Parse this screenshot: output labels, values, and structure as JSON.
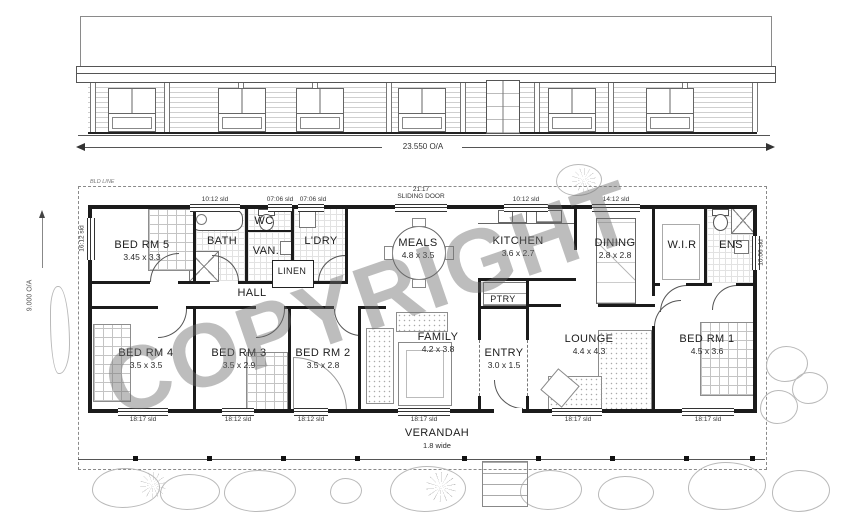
{
  "watermark": "COPYRIGHT",
  "elevation": {
    "overall_width": "23.550 O/A"
  },
  "plan": {
    "building_line_label": "BLD LINE",
    "overall_depth": "9.000 O/A",
    "verandah": {
      "name": "VERANDAH",
      "size": "1.8 wide"
    },
    "rooms": [
      {
        "name": "BED RM 5",
        "size": "3.45 x 3.3"
      },
      {
        "name": "BATH",
        "size": ""
      },
      {
        "name": "WC",
        "size": ""
      },
      {
        "name": "VAN.",
        "size": ""
      },
      {
        "name": "L'DRY",
        "size": ""
      },
      {
        "name": "LINEN",
        "size": ""
      },
      {
        "name": "HALL",
        "size": ""
      },
      {
        "name": "MEALS",
        "size": "4.8 x 3.5"
      },
      {
        "name": "KITCHEN",
        "size": "3.6 x 2.7"
      },
      {
        "name": "PTRY",
        "size": ""
      },
      {
        "name": "DINING",
        "size": "2.8 x 2.8"
      },
      {
        "name": "W.I.R",
        "size": ""
      },
      {
        "name": "ENS",
        "size": ""
      },
      {
        "name": "BED RM 4",
        "size": "3.5 x 3.5"
      },
      {
        "name": "BED RM 3",
        "size": "3.5 x 2.9"
      },
      {
        "name": "BED RM 2",
        "size": "3.5 x 2.8"
      },
      {
        "name": "FAMILY",
        "size": "4.2 x 3.8"
      },
      {
        "name": "ENTRY",
        "size": "3.0 x 1.5"
      },
      {
        "name": "LOUNGE",
        "size": "4.4 x 4.3"
      },
      {
        "name": "BED RM 1",
        "size": "4.5 x 3.6"
      }
    ],
    "openings": {
      "sliding_door_code": "21:17",
      "sliding_door_label": "SLIDING DOOR",
      "top": [
        "10:12 sld",
        "07:06 sld",
        "07:06 sld",
        "10:12 sld",
        "14:12 sld"
      ],
      "bottom": [
        "18:17 sld",
        "18:12 sld",
        "18:12 sld",
        "18:17 sld",
        "18:17 sld",
        "18:17 sld"
      ],
      "left": "16:12 sld",
      "right": "10:06 sld"
    }
  }
}
